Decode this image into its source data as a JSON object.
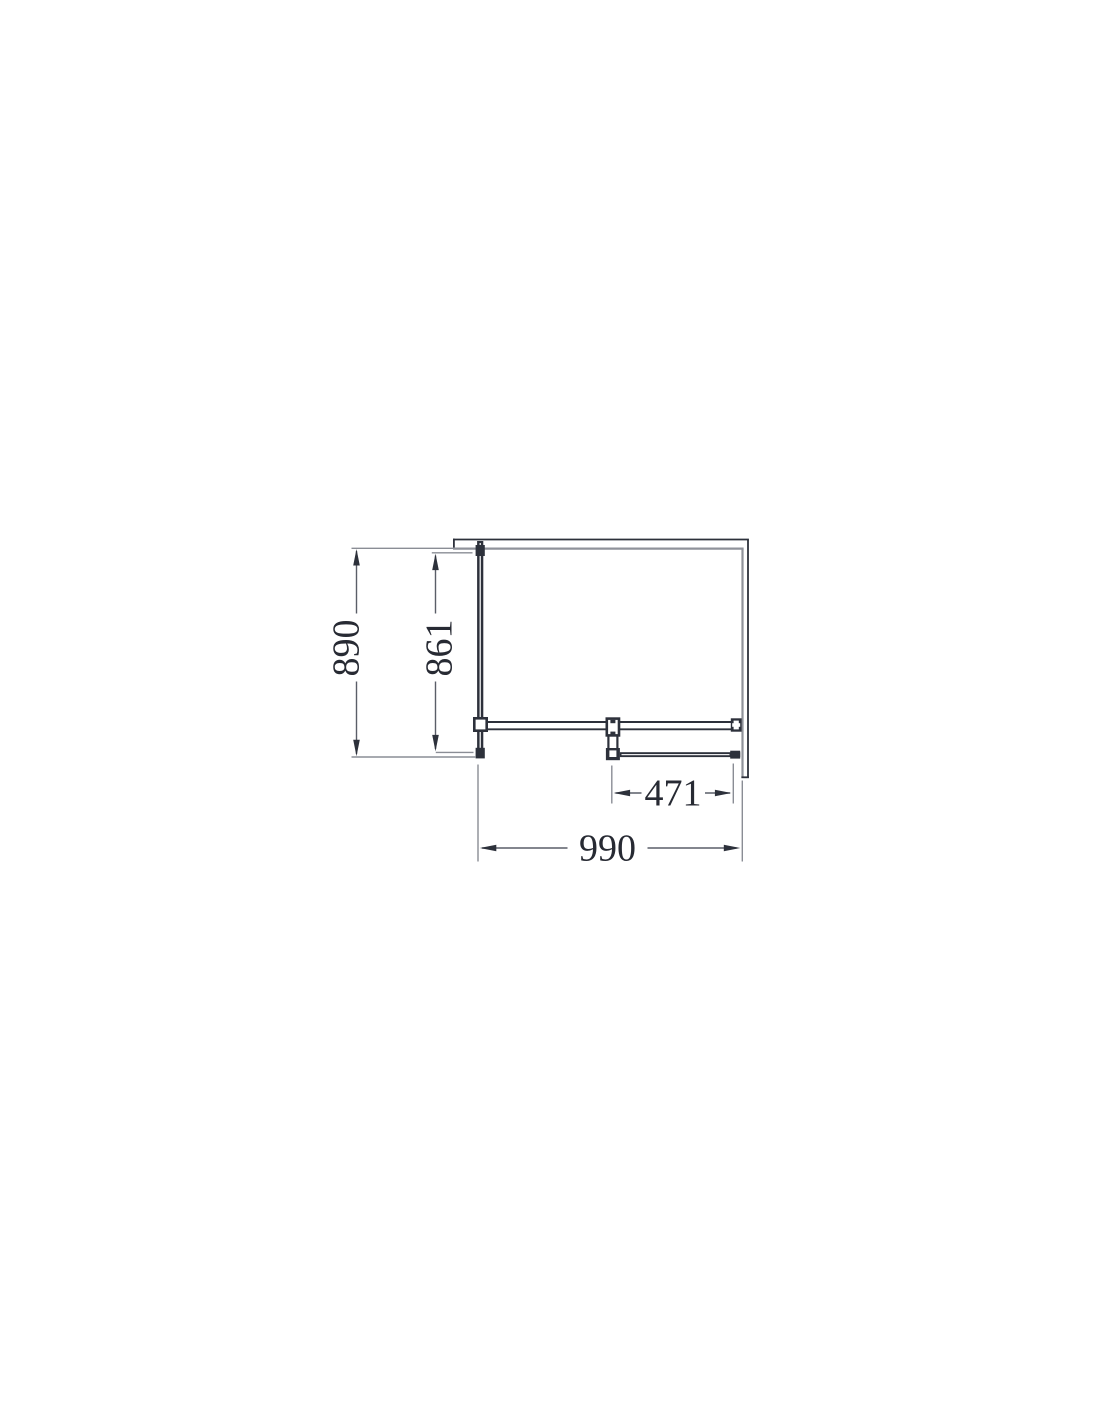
{
  "page": {
    "background": "#ffffff",
    "description": "Technical plan-view line drawing of a corner shower enclosure with dimension annotations"
  },
  "drawing": {
    "type": "technical-plan-view",
    "labels": {
      "depth_overall": "890",
      "depth_panel": "861",
      "width_overall": "990",
      "width_door": "471"
    },
    "dimensions": [
      {
        "value": "890",
        "orientation": "vertical",
        "measures": "overall-depth"
      },
      {
        "value": "861",
        "orientation": "vertical",
        "measures": "side-panel-depth"
      },
      {
        "value": "990",
        "orientation": "horizontal",
        "measures": "overall-width"
      },
      {
        "value": "471",
        "orientation": "horizontal",
        "measures": "door-width"
      }
    ],
    "colors": {
      "line_dark": "#2d313b",
      "line_gray": "#8f929a",
      "extension_line": "#8a8d95",
      "dimension_line": "#5a5e68",
      "text": "#272a33"
    }
  }
}
